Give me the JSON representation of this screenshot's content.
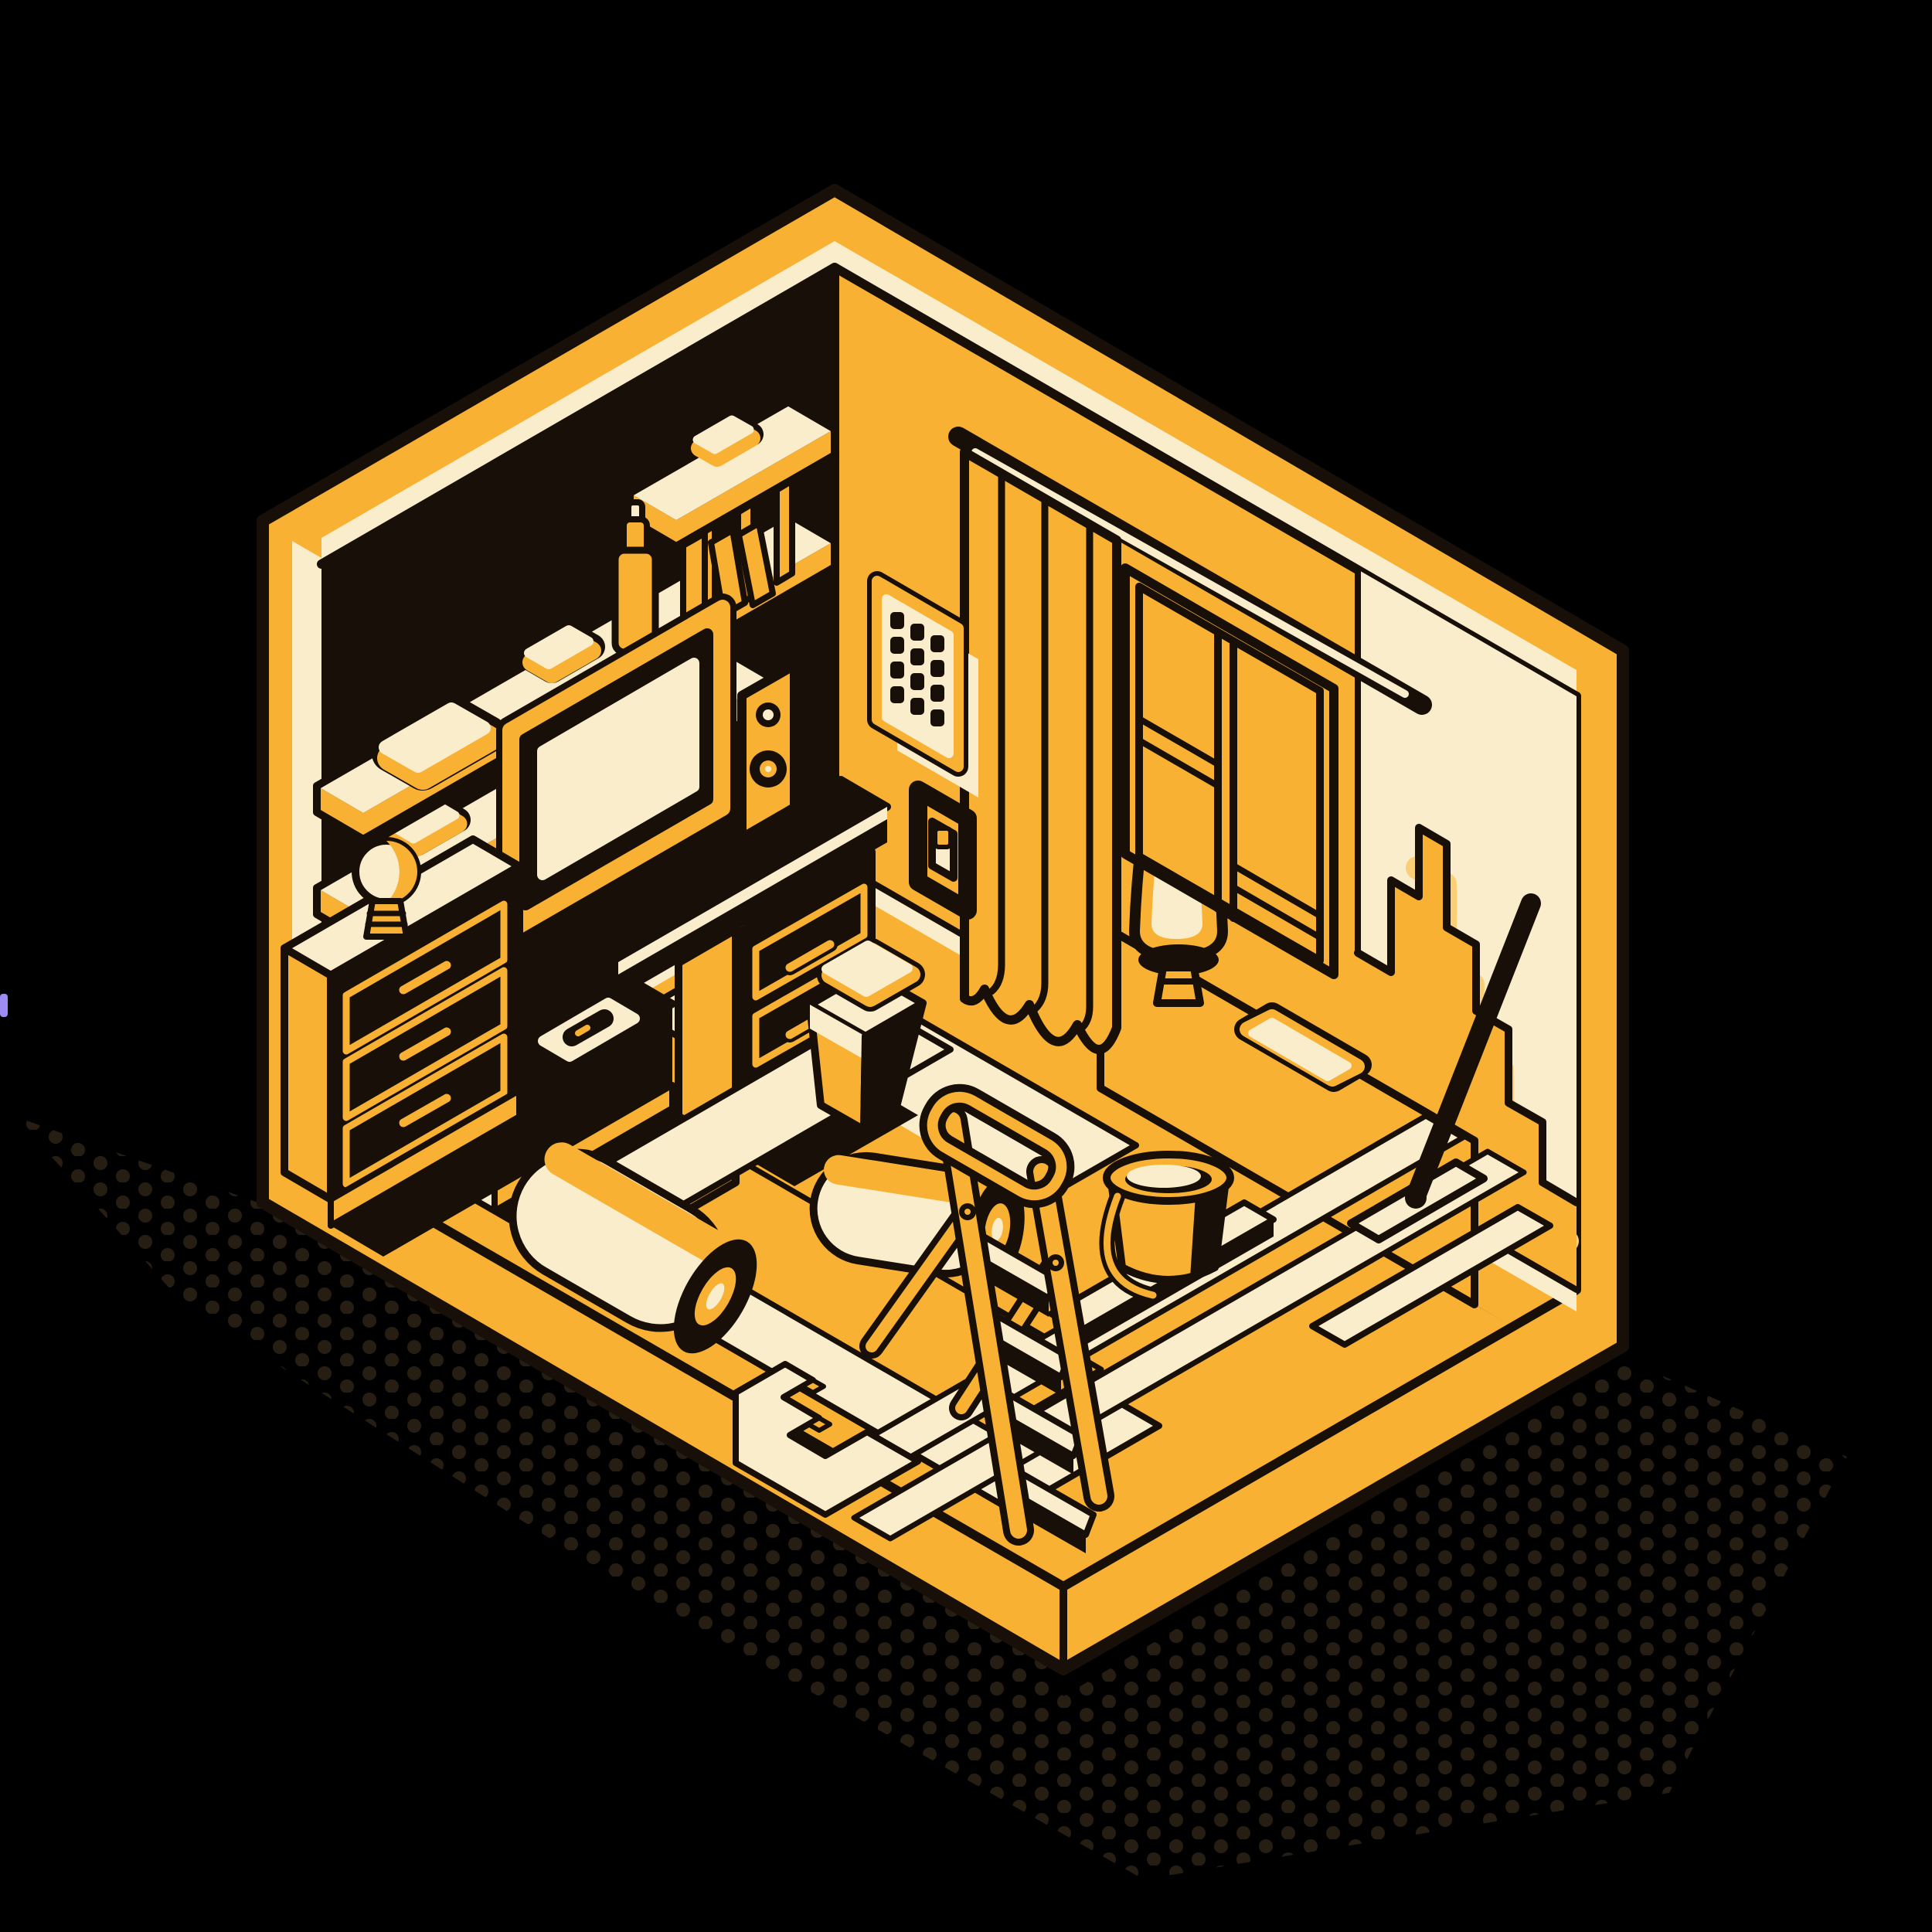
{
  "scene": {
    "label": "Isometric illustration of a room under renovation: shelves, monitor desk, dresser, window with curtain, wallpaper rolls, step ladder, paint bucket, trash bin and wall wiper",
    "style": "flat vector, black background, amber and cream duotone with dark outlines",
    "objects": [
      "left wall with three shelves, storage boxes, spray can, books",
      "monitor with speakers on desk with drawers",
      "tv console with tray and remote",
      "dresser with light bulb",
      "right wall with curtain, window, keypad, light switch",
      "window sill cabinet with cone lamp and tray",
      "partially painted stepped wall patch with wiper",
      "floor with wallpaper sheets and two wallpaper rolls",
      "step ladder with four steps",
      "paint bucket",
      "swing-lid trash bin",
      "halftone dot shadow"
    ]
  },
  "counts": {
    "shelves": 3,
    "dresser_drawers": 3,
    "desk_drawers": 3,
    "keypad_keys": 12,
    "ladder_steps": 4,
    "wallpaper_rolls": 2,
    "speakers": 2
  },
  "colors": {
    "background": "#000000",
    "amber": "#F8B133",
    "amberLight": "#FBCF77",
    "cream": "#FAEDCC",
    "ink": "#181008",
    "dot": "#271E13",
    "artifact": "#9D8DF2"
  }
}
